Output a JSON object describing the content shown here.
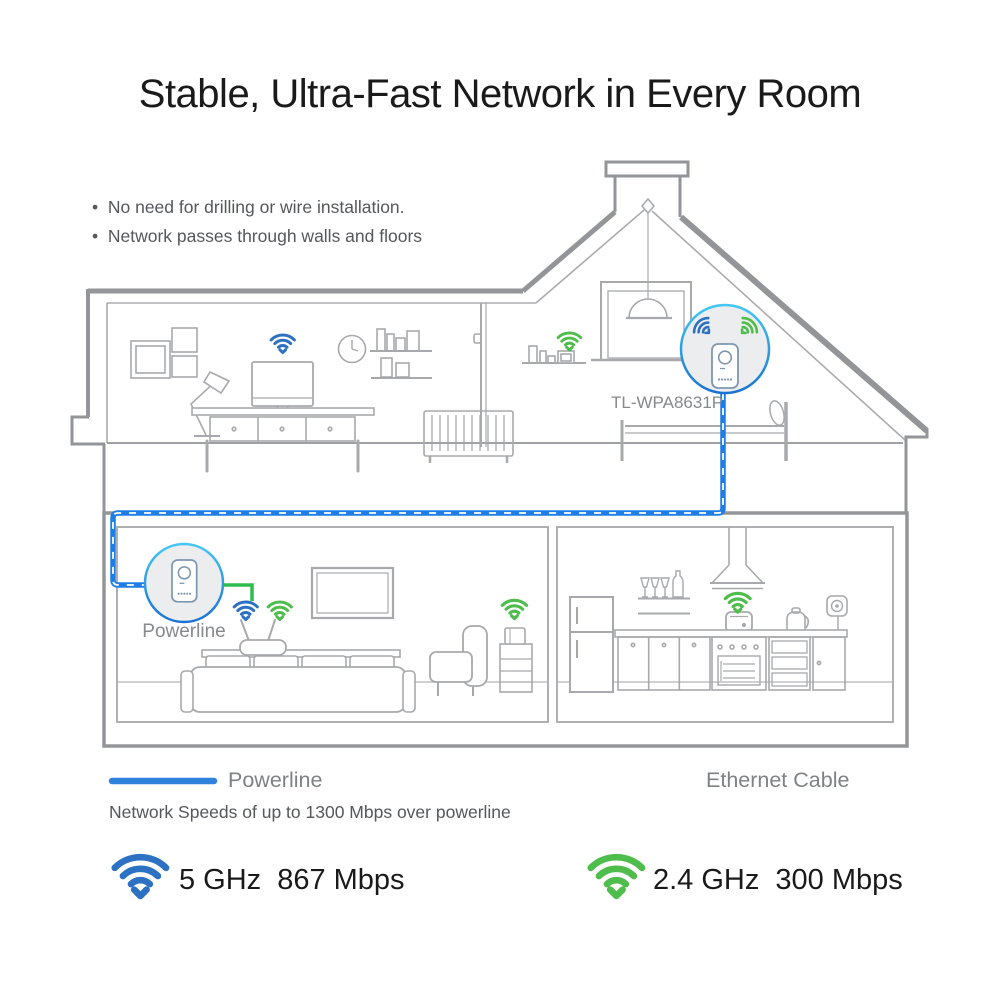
{
  "title": "Stable, Ultra-Fast Network in Every Room",
  "features": [
    "No need for drilling or wire installation.",
    "Network passes through walls and floors"
  ],
  "house": {
    "extender_label": "TL-WPA8631P",
    "adapter_label": "Powerline"
  },
  "legend": {
    "powerline": "Powerline",
    "ethernet": "Ethernet Cable",
    "note": "Network Speeds of up to 1300 Mbps over powerline"
  },
  "speeds": {
    "wifi5": {
      "band": "5 GHz",
      "rate": "867 Mbps"
    },
    "wifi24": {
      "band": "2.4 GHz",
      "rate": "300 Mbps"
    }
  },
  "colors": {
    "powerline_blue": "#1f7de6",
    "ethernet_green": "#2fbc4e",
    "wifi_blue": "#2d72c2",
    "wifi_green": "#4ebd4b",
    "circle_border_top": "#44c7f4",
    "circle_border_bottom": "#1a72d2",
    "circle_fill": "#ebedee",
    "wall_gray": "#939598",
    "furniture_gray": "#a7a9ac",
    "adapter_outline": "#7e97ae",
    "title_color": "#1a1a1b",
    "muted_text": "#55575a",
    "label_gray": "#87898c"
  }
}
